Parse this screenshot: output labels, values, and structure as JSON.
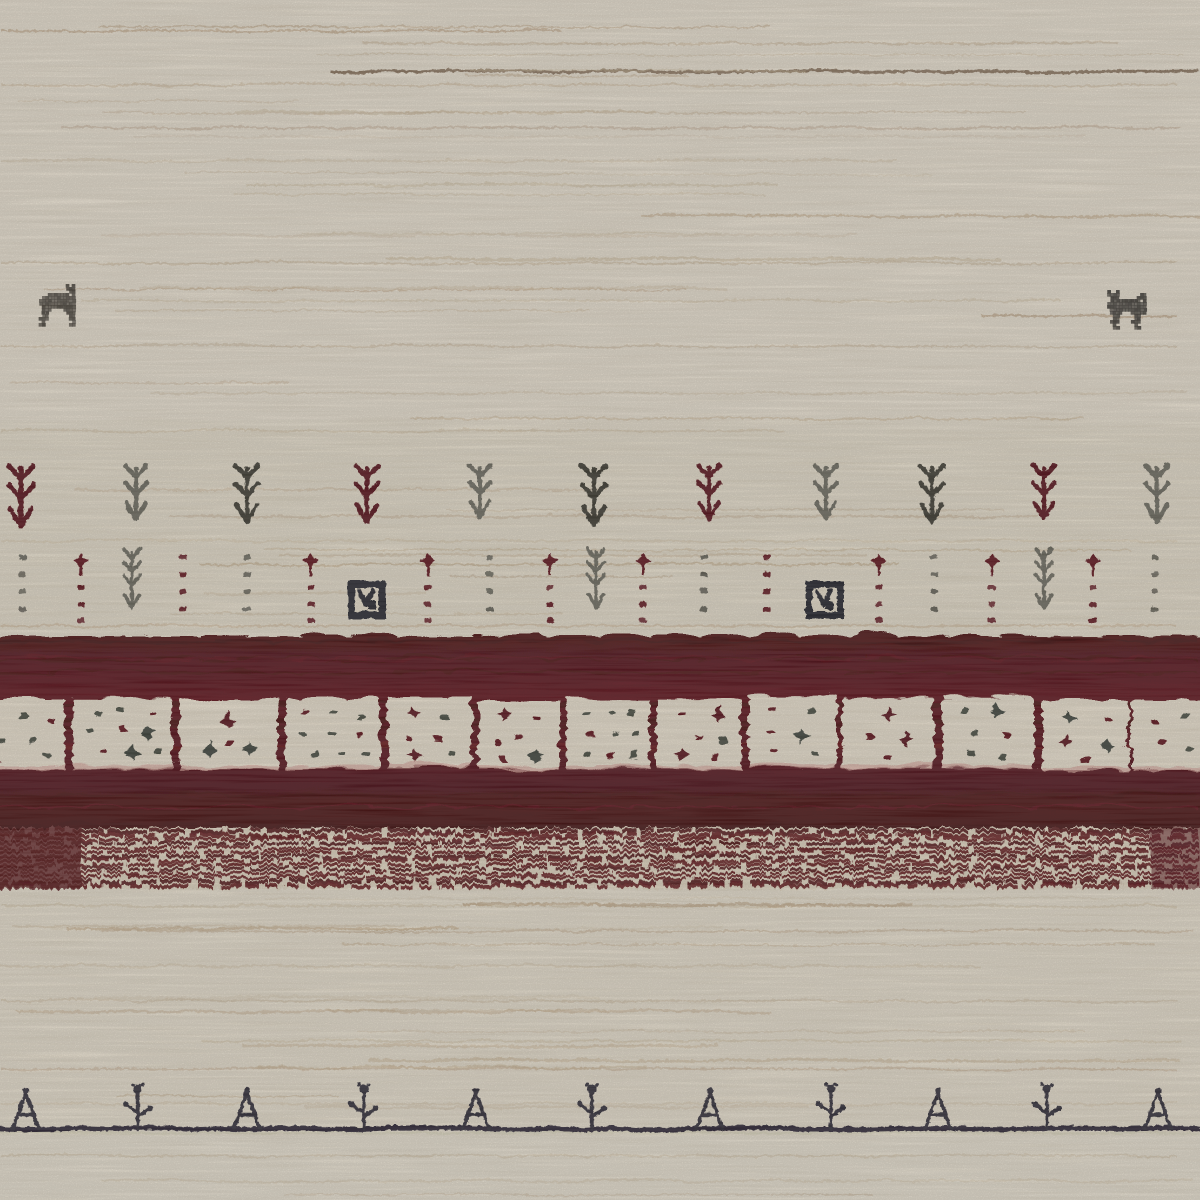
{
  "alt": "Close-up photograph of a cream hand-knotted Gabbeh wool rug with two small animal motifs, rows of plant and dot motifs, a deep maroon border band containing a row of cream squares with dots, a heathered maroon stripe band, and a bottom row of small dark plant motifs standing on a dark line",
  "palette": {
    "cream_base": "#e8dfcd",
    "cream_light": "#efe7d8",
    "cream_mid": "#e2d6c0",
    "cream_bottom": "#eae3d2",
    "maroon_base": "#551015",
    "maroon_deep": "#4a0b10",
    "maroon_dark": "#3f080d",
    "maroon_light": "#6d1319",
    "motif_maroon": "#571014",
    "motif_gray": "#6b675c",
    "motif_dark": "#3a392f",
    "motif_black": "#24232b",
    "square_fill": "#ebe1ce",
    "square_inner": "#e9dfcb",
    "square_fringe": "#d8a79d",
    "dot_gray": "#45483d",
    "dot_maroon": "#5c1115",
    "blob_gray": "#3a4138",
    "blob_maroon": "#551014",
    "baseline": "#292430",
    "baseline_glow": "#d8d3b6",
    "bottom_motif": "#2e2935"
  },
  "striations": {
    "seed": 42,
    "count": 46,
    "zones": [
      [
        6,
        626
      ],
      [
        895,
        1120
      ],
      [
        1140,
        1196
      ]
    ],
    "colors": [
      "#cdb99c",
      "#c6ae8c",
      "#b89a74",
      "#a98a63"
    ],
    "feature_lines": [
      {
        "y": 30,
        "x0": 0,
        "x1": 560,
        "c": "#b09067",
        "w": 2,
        "o": 0.5
      },
      {
        "y": 71,
        "x0": 330,
        "x1": 1200,
        "c": "#6e5138",
        "w": 3,
        "o": 0.75
      },
      {
        "y": 84,
        "x0": 0,
        "x1": 1200,
        "c": "#c9b493",
        "w": 2,
        "o": 0.5
      },
      {
        "y": 127,
        "x0": 60,
        "x1": 1200,
        "c": "#bda287",
        "w": 2,
        "o": 0.45
      },
      {
        "y": 160,
        "x0": 0,
        "x1": 900,
        "c": "#cdb99c",
        "w": 2,
        "o": 0.4
      },
      {
        "y": 215,
        "x0": 640,
        "x1": 1200,
        "c": "#b99d78",
        "w": 2.4,
        "o": 0.5
      },
      {
        "y": 262,
        "x0": 0,
        "x1": 1200,
        "c": "#c2ab8a",
        "w": 2,
        "o": 0.45
      },
      {
        "y": 300,
        "x0": 80,
        "x1": 1060,
        "c": "#cbb697",
        "w": 2,
        "o": 0.4
      },
      {
        "y": 315,
        "x0": 980,
        "x1": 1200,
        "c": "#a98a63",
        "w": 2.4,
        "o": 0.5
      },
      {
        "y": 345,
        "x0": 0,
        "x1": 1200,
        "c": "#c6b090",
        "w": 2,
        "o": 0.45
      },
      {
        "y": 392,
        "x0": 150,
        "x1": 1200,
        "c": "#cdb99c",
        "w": 2,
        "o": 0.4
      },
      {
        "y": 430,
        "x0": 0,
        "x1": 800,
        "c": "#c9b493",
        "w": 2,
        "o": 0.4
      },
      {
        "y": 540,
        "x0": 0,
        "x1": 1200,
        "c": "#cdb99c",
        "w": 2,
        "o": 0.35
      },
      {
        "y": 625,
        "x0": 0,
        "x1": 1200,
        "c": "#c0a27e",
        "w": 2,
        "o": 0.4
      },
      {
        "y": 905,
        "x0": 0,
        "x1": 1200,
        "c": "#c9b493",
        "w": 2,
        "o": 0.4
      },
      {
        "y": 930,
        "x0": 100,
        "x1": 1200,
        "c": "#bfa584",
        "w": 2,
        "o": 0.45
      },
      {
        "y": 965,
        "x0": 0,
        "x1": 1000,
        "c": "#cdb99c",
        "w": 2,
        "o": 0.4
      },
      {
        "y": 1000,
        "x0": 0,
        "x1": 1200,
        "c": "#c6b090",
        "w": 2,
        "o": 0.4
      },
      {
        "y": 1040,
        "x0": 200,
        "x1": 1200,
        "c": "#c9b493",
        "w": 2,
        "o": 0.35
      },
      {
        "y": 1068,
        "x0": 0,
        "x1": 1200,
        "c": "#c0a585",
        "w": 2,
        "o": 0.45
      },
      {
        "y": 1103,
        "x0": 0,
        "x1": 1200,
        "c": "#cdb99c",
        "w": 2,
        "o": 0.35
      },
      {
        "y": 1155,
        "x0": 0,
        "x1": 1200,
        "c": "#c9b493",
        "w": 2,
        "o": 0.4
      },
      {
        "y": 1180,
        "x0": 100,
        "x1": 1200,
        "c": "#cdb99c",
        "w": 2,
        "o": 0.35
      }
    ]
  },
  "animals": [
    {
      "x": 36,
      "y": 284,
      "cell": 3,
      "color": "#4b453c",
      "facing": "right",
      "map": [
        "..........#.#.",
        "..........###.",
        "...........##.",
        "....#######.#.",
        "..###########.",
        ".############.",
        ".############.",
        "..###########.",
        "..###....####.",
        "..##......###.",
        "..##.......##.",
        ".###.......##.",
        "..#.........#.",
        ".##........##."
      ]
    },
    {
      "x": 1104,
      "y": 290,
      "cell": 3,
      "color": "#3e3a34",
      "facing": "left",
      "map": [
        ".#..#..........",
        ".####.......##.",
        "..###......###.",
        "..##########.#.",
        ".#############.",
        ".#############.",
        "..############.",
        "..####...#####.",
        "...##.....##...",
        "...##.....##...",
        "..###....###...",
        "...#......#....",
        "...##.....##..."
      ]
    }
  ],
  "arrow_row": {
    "top": 462,
    "items": [
      {
        "x": 20,
        "c": "maroon",
        "s": 1.08
      },
      {
        "x": 135,
        "c": "gray",
        "s": 0.95
      },
      {
        "x": 246,
        "c": "dark",
        "s": 1.0
      },
      {
        "x": 366,
        "c": "maroon",
        "s": 1.0
      },
      {
        "x": 479,
        "c": "gray",
        "s": 0.92
      },
      {
        "x": 593,
        "c": "dark",
        "s": 1.05
      },
      {
        "x": 708,
        "c": "maroon",
        "s": 0.95
      },
      {
        "x": 825,
        "c": "gray",
        "s": 0.95
      },
      {
        "x": 931,
        "c": "dark",
        "s": 1.0
      },
      {
        "x": 1043,
        "c": "maroon",
        "s": 0.95
      },
      {
        "x": 1156,
        "c": "gray",
        "s": 1.0
      }
    ]
  },
  "dot_row": {
    "top": 552,
    "items": [
      {
        "x": 22,
        "k": "dots",
        "c": "gray"
      },
      {
        "x": 80,
        "k": "dots_top",
        "c": "maroon"
      },
      {
        "x": 131,
        "k": "tree",
        "c": "gray"
      },
      {
        "x": 182,
        "k": "dots",
        "c": "maroon"
      },
      {
        "x": 246,
        "k": "dots",
        "c": "gray"
      },
      {
        "x": 310,
        "k": "dots_top",
        "c": "maroon"
      },
      {
        "x": 366,
        "k": "square"
      },
      {
        "x": 427,
        "k": "dots_top",
        "c": "maroon"
      },
      {
        "x": 489,
        "k": "dots",
        "c": "gray"
      },
      {
        "x": 549,
        "k": "dots_top",
        "c": "maroon"
      },
      {
        "x": 595,
        "k": "tree",
        "c": "gray"
      },
      {
        "x": 642,
        "k": "dots_top",
        "c": "maroon"
      },
      {
        "x": 703,
        "k": "dots",
        "c": "gray"
      },
      {
        "x": 766,
        "k": "dots",
        "c": "maroon"
      },
      {
        "x": 824,
        "k": "square"
      },
      {
        "x": 878,
        "k": "dots_top",
        "c": "maroon"
      },
      {
        "x": 933,
        "k": "dots",
        "c": "gray"
      },
      {
        "x": 991,
        "k": "dots_top",
        "c": "maroon"
      },
      {
        "x": 1043,
        "k": "tree",
        "c": "gray"
      },
      {
        "x": 1092,
        "k": "dots_top",
        "c": "maroon"
      },
      {
        "x": 1154,
        "k": "dots",
        "c": "gray"
      }
    ]
  },
  "border_block": {
    "top": 633,
    "bottom": 828,
    "streak_seed": 7,
    "squares": {
      "y": 696,
      "h": 70,
      "items": [
        {
          "x": -28,
          "w": 90,
          "dots": [
            [
              0.25,
              0.3,
              "g"
            ],
            [
              0.55,
              0.25,
              "g"
            ],
            [
              0.85,
              0.3,
              "m"
            ],
            [
              0.3,
              0.6,
              "g"
            ],
            [
              0.65,
              0.6,
              "g"
            ],
            [
              0.25,
              0.85,
              "m"
            ],
            [
              0.8,
              0.8,
              "g"
            ]
          ]
        },
        {
          "x": 70,
          "w": 100,
          "dots": [
            [
              0.25,
              0.2,
              "g"
            ],
            [
              0.5,
              0.18,
              "g"
            ],
            [
              0.8,
              0.22,
              "m"
            ],
            [
              0.2,
              0.45,
              "g"
            ],
            [
              0.5,
              0.45,
              "m"
            ],
            [
              0.75,
              0.5,
              "G"
            ],
            [
              0.3,
              0.75,
              "m"
            ],
            [
              0.6,
              0.8,
              "G"
            ],
            [
              0.85,
              0.75,
              "g"
            ]
          ]
        },
        {
          "x": 178,
          "w": 98,
          "dots": [
            [
              0.5,
              0.3,
              "M"
            ],
            [
              0.3,
              0.7,
              "G"
            ],
            [
              0.7,
              0.7,
              "G"
            ],
            [
              0.5,
              0.62,
              "m"
            ]
          ]
        },
        {
          "x": 284,
          "w": 94,
          "dots": [
            [
              0.2,
              0.2,
              "m"
            ],
            [
              0.5,
              0.2,
              "g"
            ],
            [
              0.8,
              0.25,
              "g"
            ],
            [
              0.2,
              0.5,
              "g"
            ],
            [
              0.5,
              0.5,
              "g"
            ],
            [
              0.8,
              0.5,
              "m"
            ],
            [
              0.3,
              0.8,
              "g"
            ],
            [
              0.6,
              0.8,
              "g"
            ],
            [
              0.85,
              0.8,
              "g"
            ]
          ]
        },
        {
          "x": 386,
          "w": 84,
          "dots": [
            [
              0.3,
              0.25,
              "M"
            ],
            [
              0.7,
              0.3,
              "g"
            ],
            [
              0.25,
              0.6,
              "m"
            ],
            [
              0.6,
              0.6,
              "m"
            ],
            [
              0.3,
              0.85,
              "M"
            ],
            [
              0.75,
              0.8,
              "g"
            ]
          ]
        },
        {
          "x": 477,
          "w": 80,
          "dots": [
            [
              0.3,
              0.2,
              "M"
            ],
            [
              0.7,
              0.25,
              "m"
            ],
            [
              0.5,
              0.55,
              "m"
            ],
            [
              0.25,
              0.6,
              "m"
            ],
            [
              0.3,
              0.85,
              "m"
            ],
            [
              0.7,
              0.8,
              "G"
            ]
          ]
        },
        {
          "x": 564,
          "w": 83,
          "dots": [
            [
              0.25,
              0.2,
              "g"
            ],
            [
              0.55,
              0.2,
              "g"
            ],
            [
              0.8,
              0.2,
              "g"
            ],
            [
              0.3,
              0.5,
              "m"
            ],
            [
              0.6,
              0.5,
              "g"
            ],
            [
              0.85,
              0.5,
              "g"
            ],
            [
              0.25,
              0.8,
              "g"
            ],
            [
              0.55,
              0.8,
              "m"
            ],
            [
              0.8,
              0.8,
              "g"
            ]
          ]
        },
        {
          "x": 654,
          "w": 85,
          "dots": [
            [
              0.3,
              0.25,
              "m"
            ],
            [
              0.75,
              0.25,
              "M"
            ],
            [
              0.5,
              0.55,
              "m"
            ],
            [
              0.8,
              0.6,
              "g"
            ],
            [
              0.3,
              0.8,
              "M"
            ],
            [
              0.7,
              0.85,
              "m"
            ]
          ]
        },
        {
          "x": 746,
          "w": 89,
          "dots": [
            [
              0.3,
              0.2,
              "m"
            ],
            [
              0.7,
              0.2,
              "g"
            ],
            [
              0.25,
              0.5,
              "m"
            ],
            [
              0.6,
              0.55,
              "G"
            ],
            [
              0.3,
              0.8,
              "m"
            ],
            [
              0.75,
              0.8,
              "g"
            ]
          ]
        },
        {
          "x": 840,
          "w": 92,
          "dots": [
            [
              0.5,
              0.25,
              "M"
            ],
            [
              0.3,
              0.55,
              "m"
            ],
            [
              0.7,
              0.6,
              "M"
            ],
            [
              0.5,
              0.85,
              "m"
            ]
          ]
        },
        {
          "x": 940,
          "w": 92,
          "dots": [
            [
              0.25,
              0.2,
              "g"
            ],
            [
              0.6,
              0.2,
              "G"
            ],
            [
              0.35,
              0.5,
              "g"
            ],
            [
              0.7,
              0.55,
              "m"
            ],
            [
              0.3,
              0.8,
              "g"
            ],
            [
              0.65,
              0.85,
              "g"
            ]
          ]
        },
        {
          "x": 1040,
          "w": 87,
          "dots": [
            [
              0.3,
              0.25,
              "G"
            ],
            [
              0.75,
              0.3,
              "m"
            ],
            [
              0.3,
              0.6,
              "M"
            ],
            [
              0.75,
              0.65,
              "G"
            ],
            [
              0.5,
              0.85,
              "m"
            ]
          ]
        },
        {
          "x": 1130,
          "w": 75,
          "dots": [
            [
              0.3,
              0.3,
              "m"
            ],
            [
              0.7,
              0.25,
              "g"
            ],
            [
              0.4,
              0.6,
              "m"
            ],
            [
              0.75,
              0.7,
              "g"
            ]
          ]
        }
      ]
    }
  },
  "stripe_band": {
    "top": 828,
    "h": 61,
    "rows": 14,
    "seed": 5
  },
  "bottom_row": {
    "baseline_y": 1128,
    "items": [
      {
        "x": 25,
        "t": "tri"
      },
      {
        "x": 137,
        "t": "flo"
      },
      {
        "x": 246,
        "t": "tri"
      },
      {
        "x": 363,
        "t": "flo"
      },
      {
        "x": 475,
        "t": "tri"
      },
      {
        "x": 591,
        "t": "flo"
      },
      {
        "x": 709,
        "t": "tri"
      },
      {
        "x": 830,
        "t": "flo"
      },
      {
        "x": 937,
        "t": "tri"
      },
      {
        "x": 1046,
        "t": "flo"
      },
      {
        "x": 1157,
        "t": "tri"
      }
    ]
  },
  "texture": {
    "dark_opacity": 0.11,
    "streak_opacity": 0.1,
    "light_opacity": 0.13
  }
}
